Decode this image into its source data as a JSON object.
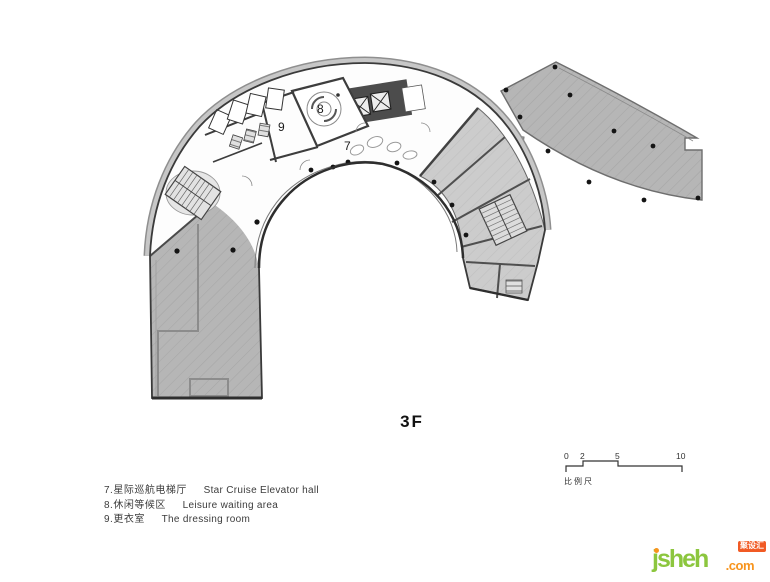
{
  "plan": {
    "floor_title": "3F",
    "rooms": [
      {
        "number": "7"
      },
      {
        "number": "8"
      },
      {
        "number": "9"
      }
    ]
  },
  "legend": {
    "items": [
      {
        "label_cn": "7.星际巡航电梯厅",
        "label_en": "Star Cruise Elevator hall"
      },
      {
        "label_cn": "8.休闲等候区",
        "label_en": "Leisure waiting area"
      },
      {
        "label_cn": "9.更衣室",
        "label_en": "The dressing room"
      }
    ]
  },
  "scale_bar": {
    "ticks": [
      "0",
      "2",
      "5",
      "10"
    ],
    "label": "比例尺"
  },
  "logo": {
    "name": "jsheh",
    "tld": ".com",
    "badge": "聚设汇"
  },
  "colors": {
    "terrace_gray": "#b6b6b6",
    "room_gray": "#cbcbcb",
    "canopy_gray": "#c7c7c7",
    "wall_dark": "#3a3a3a",
    "logo_green": "#8CC63E",
    "logo_orange": "#F7941D",
    "badge_orange": "#F15A24"
  }
}
